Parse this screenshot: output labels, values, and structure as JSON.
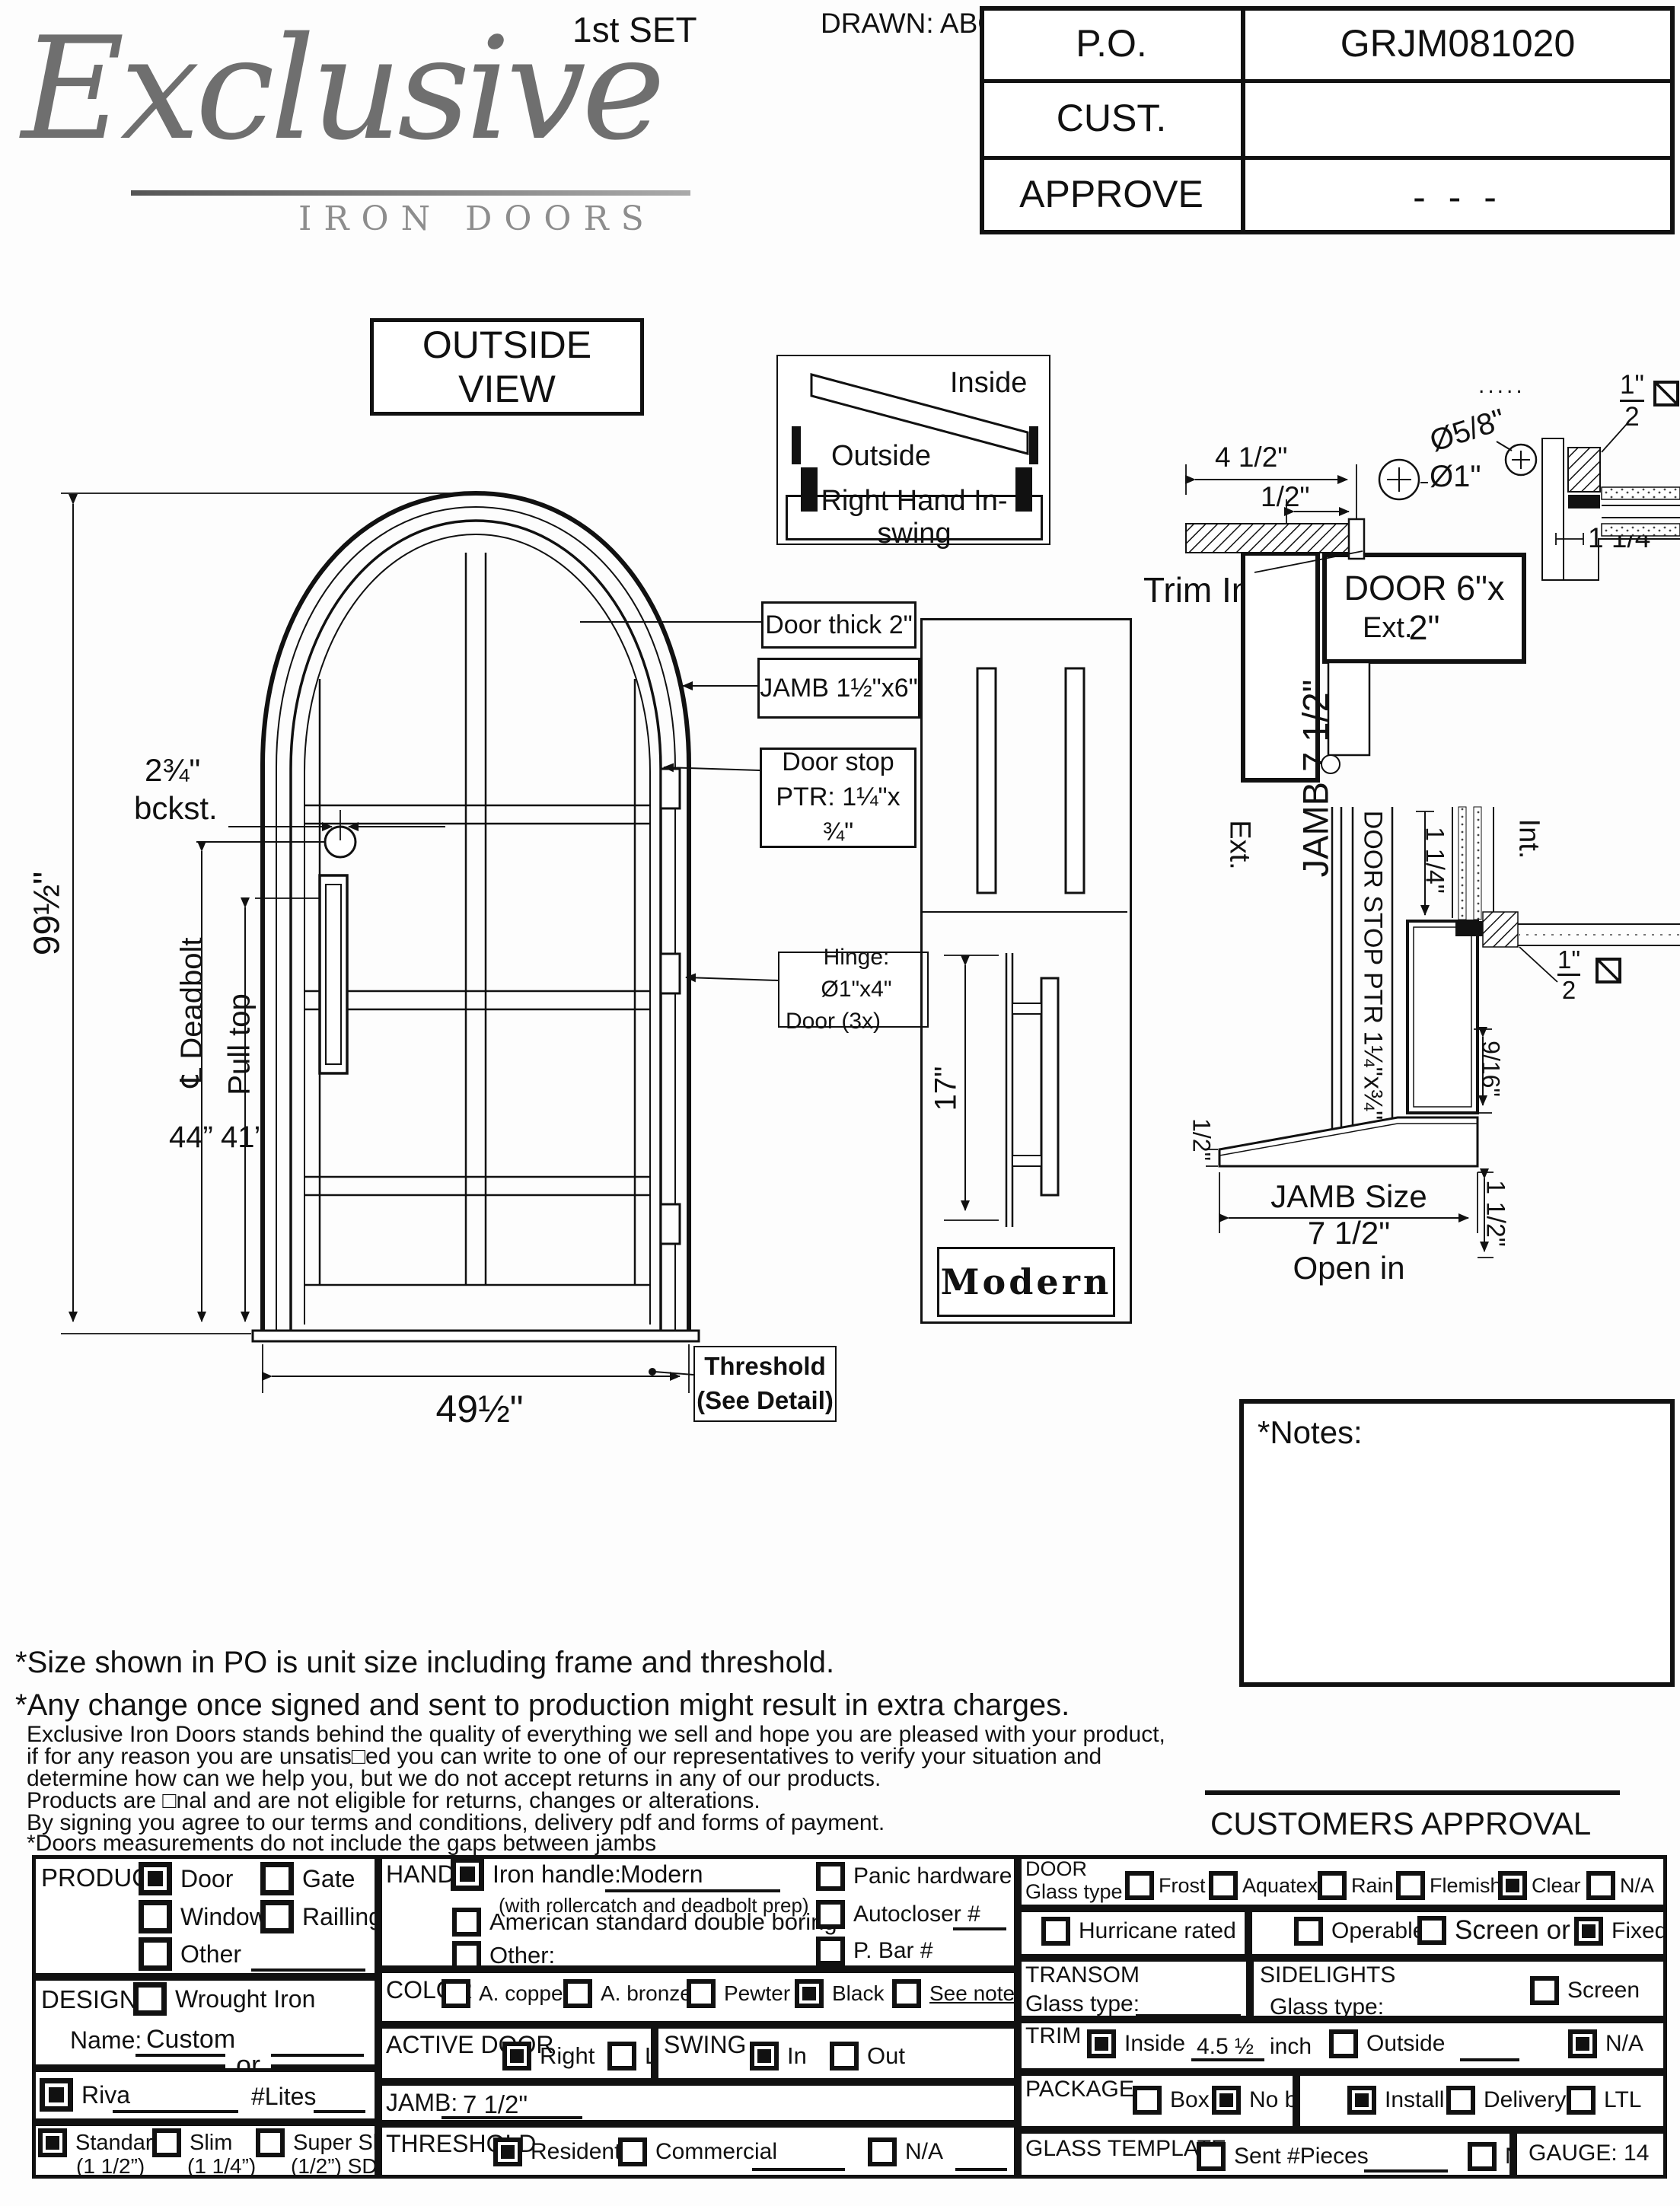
{
  "header": {
    "logo_script": "Exclusive",
    "logo_sub": "IRON DOORS",
    "set_label": "1st SET",
    "drawn": "DRAWN: ABG",
    "po": {
      "label": "P.O.",
      "value": "GRJM081020"
    },
    "cust": {
      "label": "CUST.",
      "value": ""
    },
    "approve": {
      "label": "APPROVE",
      "value": "- - -"
    }
  },
  "view": {
    "title": "OUTSIDE VIEW"
  },
  "swing_diagram": {
    "inside": "Inside",
    "outside": "Outside",
    "label": "Right Hand In-swing"
  },
  "elevation": {
    "height_dim": "99½\"",
    "width_dim": "49½\"",
    "backset_top": "2¾\"",
    "backset_bot": "bckst.",
    "deadbolt": "℄ Deadbolt",
    "pull_top": "Pull top",
    "dim_44": "44”",
    "dim_41": "41”",
    "door_thick": "Door thick 2\"",
    "jamb": "JAMB  1½\"x6\"",
    "door_stop_1": "Door stop",
    "door_stop_2": "PTR: 1¼\"x ¾\"",
    "hinge_1": "Hinge: Ø1\"x4\"",
    "hinge_2": "Door (3x)",
    "threshold_1": "Threshold",
    "threshold_2": "(See Detail)"
  },
  "handle_detail": {
    "dim": "17\"",
    "name": "Modern"
  },
  "head_detail": {
    "dots": ".....",
    "dim_a": "4 1/2\"",
    "dim_b": "1/2\"",
    "trim_int": "Trim Int.",
    "jamb_vert": "JAMB 7 1/2\"",
    "dia_1": "Ø1\"",
    "dia_58": "Ø5/8\"",
    "door_6x2": "DOOR 6\"x 2\"",
    "frac_top": "1\"",
    "frac_bot": "2",
    "dim_114": "1 1/4\"",
    "ext": "Ext."
  },
  "threshold_detail": {
    "ext": "Ext.",
    "int": "Int.",
    "door_stop_vert": "DOOR STOP PTR 1¼\"x¾\"",
    "door_2x6": "DOOR 2\" x 6\"",
    "dim_114": "1 1/4\"",
    "frac_top": "1\"",
    "frac_bot": "2",
    "dim_916": "9/16\"",
    "dim_half": "1/2\"",
    "jamb_size_1": "JAMB Size",
    "jamb_size_2": "7 1/2\"",
    "jamb_size_3": "Open in",
    "dim_112": "1 1/2\""
  },
  "notes": {
    "title": "*Notes:"
  },
  "disclaimer": {
    "line1": "*Size shown in PO is unit size including frame and threshold.",
    "line2": "*Any change once signed and sent to production might result in extra charges.",
    "small1": "Exclusive Iron Doors stands behind the quality of everything we sell and hope you are pleased with your product,",
    "small2": "if for any reason you are unsatis□ed you can write to one of our representatives to verify your situation and",
    "small3": "determine how can we help you, but we do not accept returns in any of our products.",
    "small4": "Products are □nal and are not eligible for returns, changes or alterations.",
    "small5": "By signing you agree to our terms and conditions, delivery pdf and forms of payment.",
    "small6": "*Doors measurements do not include the gaps between jambs"
  },
  "approval": {
    "label": "CUSTOMERS APPROVAL"
  },
  "form": {
    "product": {
      "title": "PRODUCT:",
      "door": {
        "label": "Door",
        "checked": true
      },
      "gate": {
        "label": "Gate",
        "checked": false
      },
      "window": {
        "label": "Window",
        "checked": false
      },
      "railing": {
        "label": "Railling",
        "checked": false
      },
      "other": {
        "label": "Other",
        "checked": false
      }
    },
    "design": {
      "title": "DESIGN:",
      "wrought": {
        "label": "Wrought Iron",
        "checked": false
      },
      "name_label": "Name:",
      "name_value": "Custom",
      "or_label": "or",
      "riva": {
        "label": "Riva",
        "checked": true
      },
      "lites": "#Lites",
      "standard": {
        "label": "Standard",
        "sub": "(1 1/2”)",
        "checked": true
      },
      "slim": {
        "label": "Slim",
        "sub": "(1 1/4”)",
        "checked": false
      },
      "super_slim": {
        "label": "Super Slim",
        "sub": "(1/2”) SDL",
        "checked": false
      }
    },
    "handle": {
      "title": "HANDLE",
      "iron": {
        "label": "Iron handle:",
        "checked": true
      },
      "iron_value": "Modern",
      "iron_note": "(with rollercatch and deadbolt prep)",
      "american": {
        "label": "American standard double boring",
        "checked": false
      },
      "other": {
        "label": "Other:",
        "checked": false
      },
      "panic": {
        "label": "Panic hardware",
        "checked": false
      },
      "autocloser": {
        "label": "Autocloser #",
        "checked": false
      },
      "pbar": {
        "label": "P. Bar #",
        "checked": false
      }
    },
    "color": {
      "title": "COLOR",
      "copper": {
        "label": "A. copper",
        "checked": false
      },
      "bronze": {
        "label": "A. bronze",
        "checked": false
      },
      "pewter": {
        "label": "Pewter",
        "checked": false
      },
      "black": {
        "label": "Black",
        "checked": true
      },
      "see_notes": {
        "label": "See notes*",
        "checked": false
      }
    },
    "active_door": {
      "title": "ACTIVE DOOR",
      "right": {
        "label": "Right",
        "checked": true
      },
      "left": {
        "label": "Left",
        "checked": false
      }
    },
    "swing": {
      "title": "SWING",
      "in": {
        "label": "In",
        "checked": true
      },
      "out": {
        "label": "Out",
        "checked": false
      }
    },
    "jamb": {
      "title": "JAMB:",
      "value": "7 1/2\""
    },
    "threshold": {
      "title": "THRESHOLD",
      "residential": {
        "label": "Residential",
        "checked": true
      },
      "commercial": {
        "label": "Commercial",
        "checked": false
      },
      "na": {
        "label": "N/A",
        "checked": false
      }
    },
    "door_glass": {
      "title": "DOOR",
      "subtitle": "Glass type",
      "frost": {
        "label": "Frost",
        "checked": false
      },
      "aquatex": {
        "label": "Aquatex",
        "checked": false
      },
      "rain": {
        "label": "Rain",
        "checked": false
      },
      "flemish": {
        "label": "Flemish",
        "checked": false
      },
      "clear": {
        "label": "Clear",
        "checked": true
      },
      "na": {
        "label": "N/A",
        "checked": false
      }
    },
    "hurricane": {
      "label": "Hurricane rated",
      "checked": false
    },
    "operable": {
      "label": "Operable",
      "checked": false
    },
    "screen_or": {
      "label": "Screen or",
      "checked": false
    },
    "fixed": {
      "label": "Fixed",
      "checked": true
    },
    "transom": {
      "title": "TRANSOM",
      "glass_label": "Glass type:"
    },
    "sidelights": {
      "title": "SIDELIGHTS",
      "glass_label": "Glass type:",
      "screen": {
        "label": "Screen",
        "checked": false
      }
    },
    "trim": {
      "title": "TRIM",
      "inside": {
        "label": "Inside",
        "checked": true
      },
      "inside_value": "4.5 ½",
      "inside_unit": "inch",
      "outside": {
        "label": "Outside",
        "checked": false
      },
      "na": {
        "label": "N/A",
        "checked": true
      }
    },
    "package": {
      "title": "PACKAGE",
      "box": {
        "label": "Box",
        "checked": false
      },
      "nobox": {
        "label": "No box",
        "checked": true
      },
      "install": {
        "label": "Install",
        "checked": true
      },
      "delivery": {
        "label": "Delivery",
        "checked": false
      },
      "ltl": {
        "label": "LTL",
        "checked": false
      }
    },
    "glass_template": {
      "title": "GLASS TEMPLATE",
      "sent": {
        "label": "Sent #Pieces",
        "checked": false
      },
      "na": {
        "label": "N/A",
        "checked": false
      },
      "gauge": "GAUGE: 14"
    }
  }
}
